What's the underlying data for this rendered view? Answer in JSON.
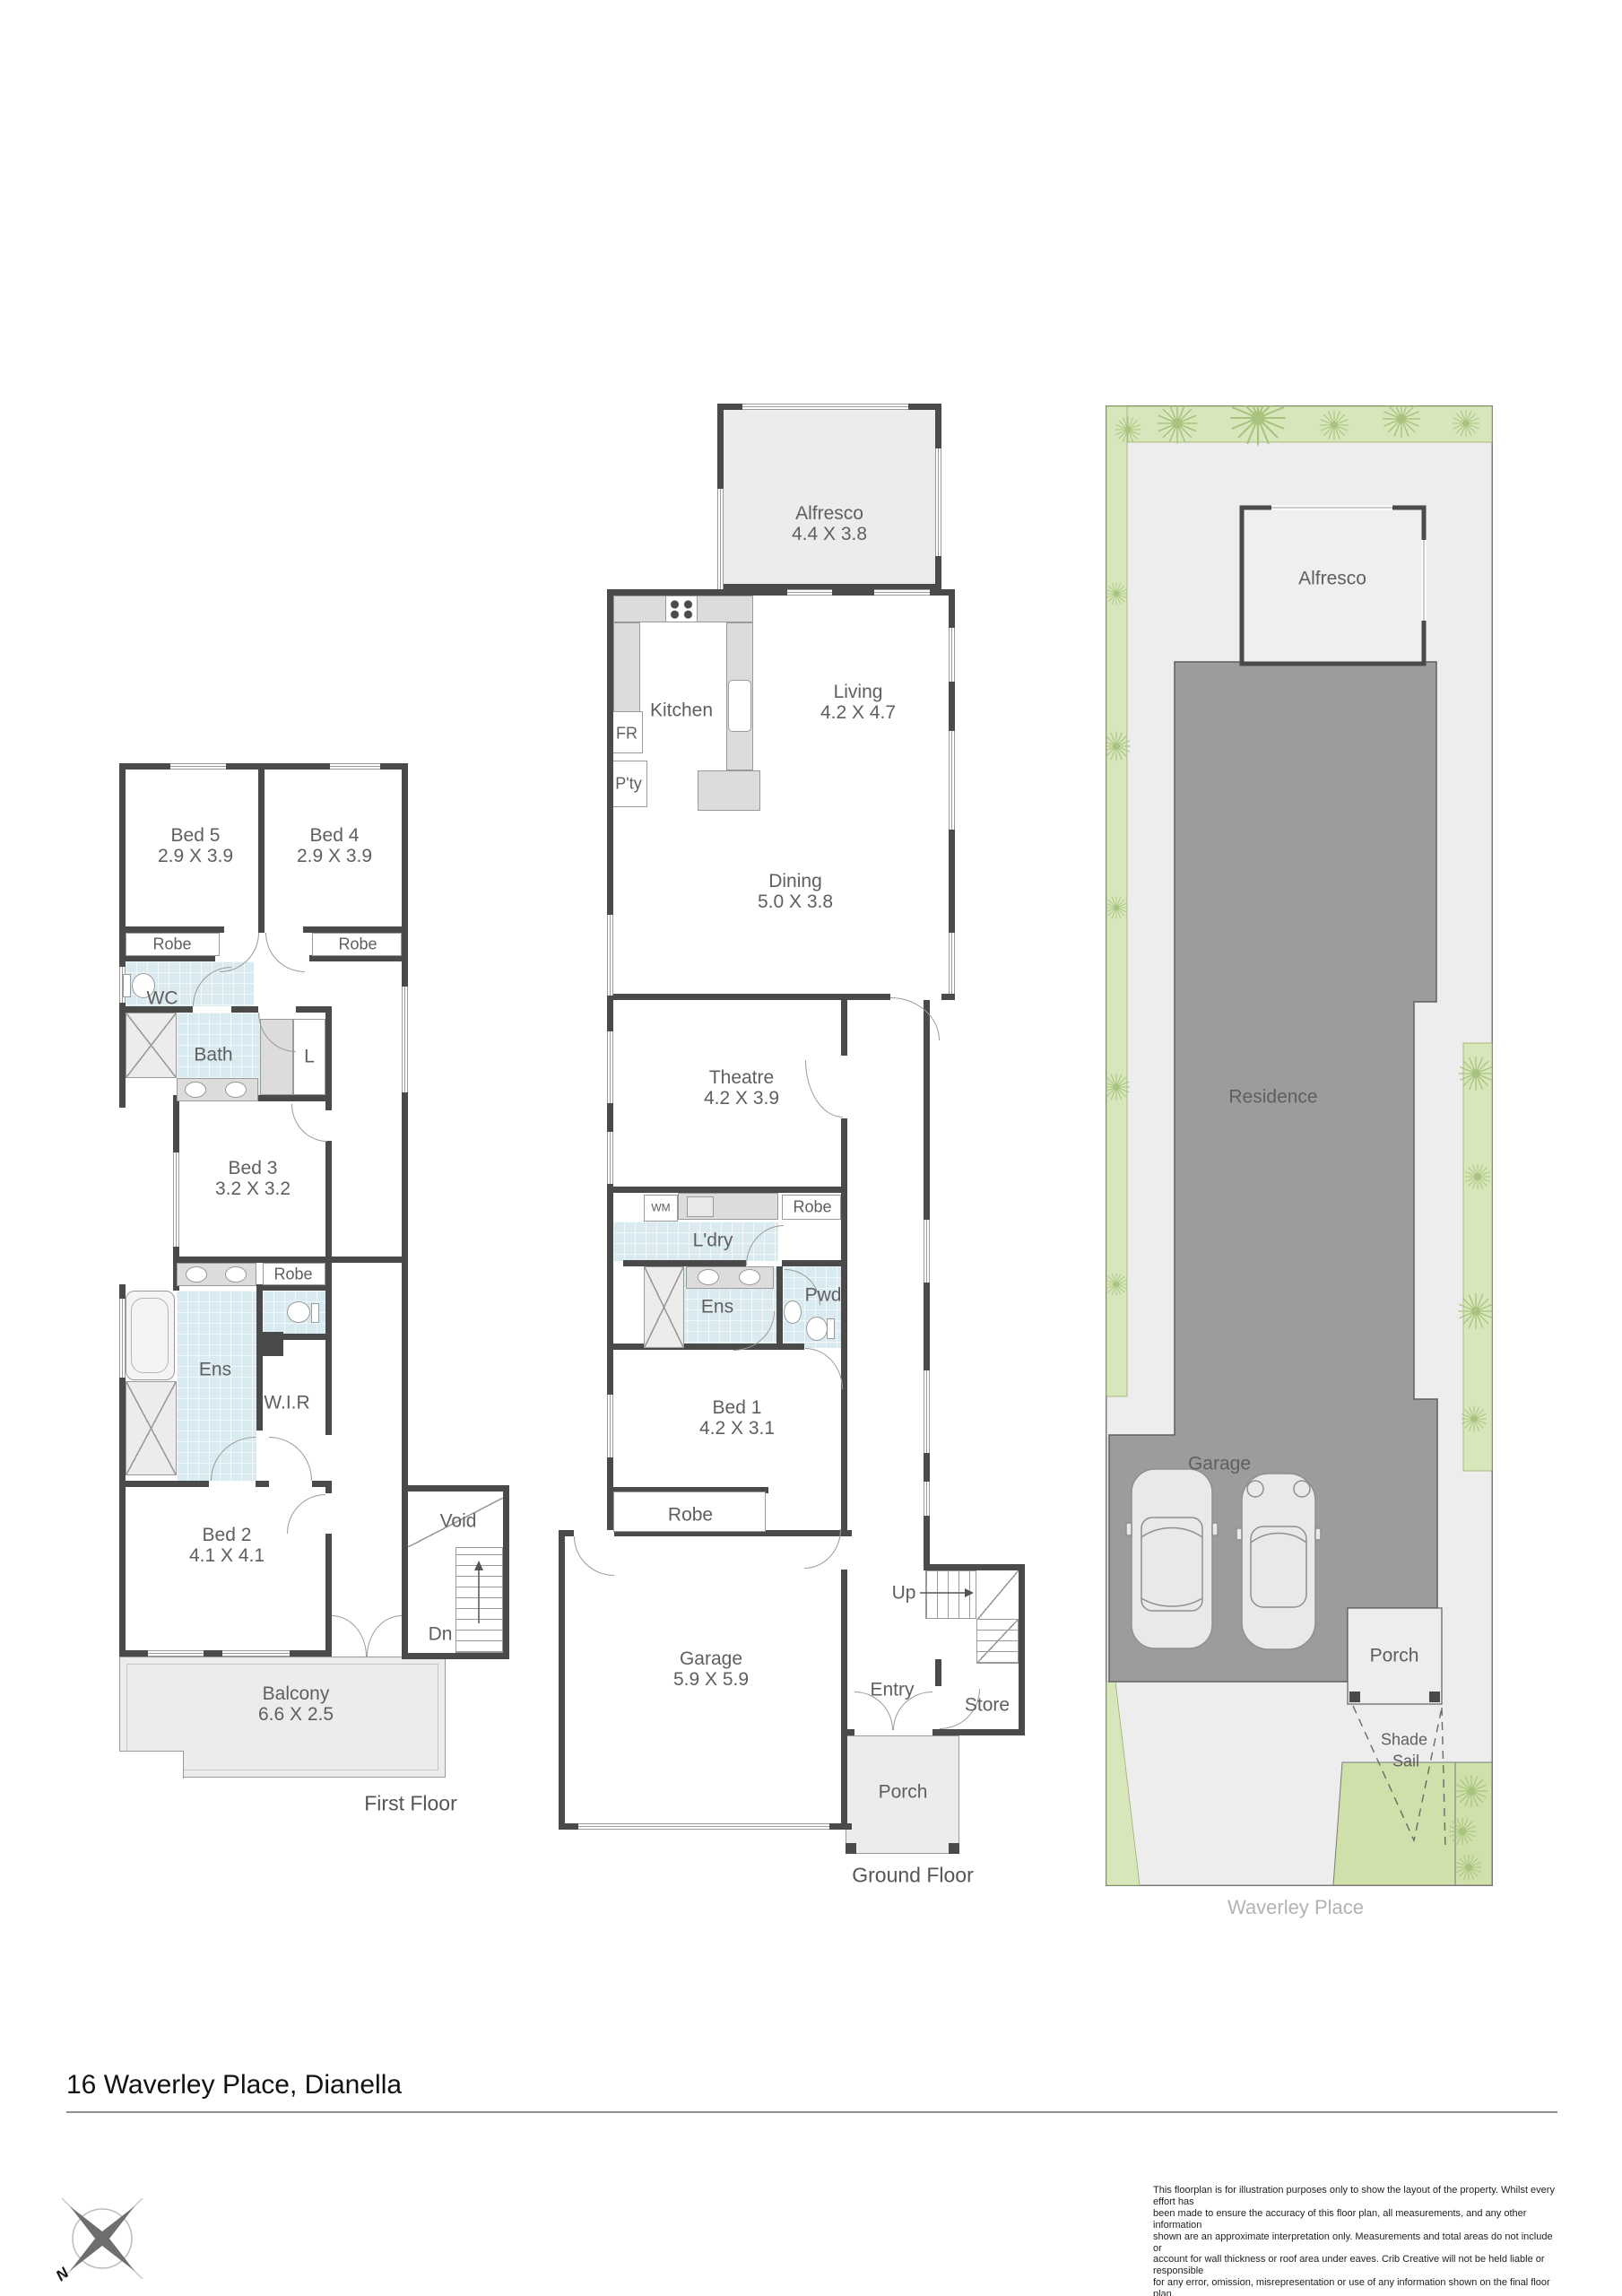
{
  "colors": {
    "wall": "#4a4a4a",
    "tile_blue": "#d9ebf1",
    "counter_gray": "#dcdcdc",
    "paved_gray": "#ececec",
    "site_building_gray": "#9c9c9c",
    "greenery": "#d8e6bb",
    "lawn": "#cfe0ab",
    "label_gray": "#5f5f5f",
    "street_label_gray": "#b3b3b3"
  },
  "first_floor": {
    "caption": "First Floor",
    "bed5": {
      "name": "Bed 5",
      "dims": "2.9 X 3.9"
    },
    "bed4": {
      "name": "Bed 4",
      "dims": "2.9 X 3.9"
    },
    "robe_bed5": "Robe",
    "robe_bed4": "Robe",
    "wc": "WC",
    "bath": "Bath",
    "linen": "L",
    "bed3": {
      "name": "Bed 3",
      "dims": "3.2 X 3.2"
    },
    "robe_bed3": "Robe",
    "ens": "Ens",
    "wir": "W.I.R",
    "bed2": {
      "name": "Bed 2",
      "dims": "4.1 X 4.1"
    },
    "void": "Void",
    "dn": "Dn",
    "balcony": {
      "name": "Balcony",
      "dims": "6.6 X 2.5"
    }
  },
  "ground_floor": {
    "caption": "Ground Floor",
    "alfresco": {
      "name": "Alfresco",
      "dims": "4.4 X 3.8"
    },
    "kitchen": "Kitchen",
    "fridge": "FR",
    "pantry": "P'ty",
    "living": {
      "name": "Living",
      "dims": "4.2 X 4.7"
    },
    "dining": {
      "name": "Dining",
      "dims": "5.0 X 3.8"
    },
    "theatre": {
      "name": "Theatre",
      "dims": "4.2 X 3.9"
    },
    "wm": "WM",
    "robe_hall": "Robe",
    "laundry": "L'dry",
    "ens": "Ens",
    "powder": "Pwd",
    "bed1": {
      "name": "Bed 1",
      "dims": "4.2 X 3.1"
    },
    "robe_bed1": "Robe",
    "garage": {
      "name": "Garage",
      "dims": "5.9 X 5.9"
    },
    "up": "Up",
    "entry": "Entry",
    "store": "Store",
    "porch": "Porch"
  },
  "site_plan": {
    "alfresco": "Alfresco",
    "residence": "Residence",
    "garage": "Garage",
    "porch": "Porch",
    "shade_sail_line1": "Shade",
    "shade_sail_line2": "Sail",
    "street": "Waverley Place",
    "compass_north": "N"
  },
  "footer": {
    "address": "16 Waverley Place, Dianella",
    "disclaimer": "This floorplan is for illustration purposes only to show the layout of the property. Whilst every effort has\nbeen made to ensure the accuracy of this floor plan, all measurements, and any other information\nshown are an approximate interpretation only. Measurements and total areas do not include or\naccount for wall thickness or roof area under eaves. Crib Creative will not be held liable or responsible\nfor any error, omission, misrepresentation or use of any information shown on the final floor plan.\nNot to be used for any other purpose.\nwww.cribcreative.com.au"
  }
}
